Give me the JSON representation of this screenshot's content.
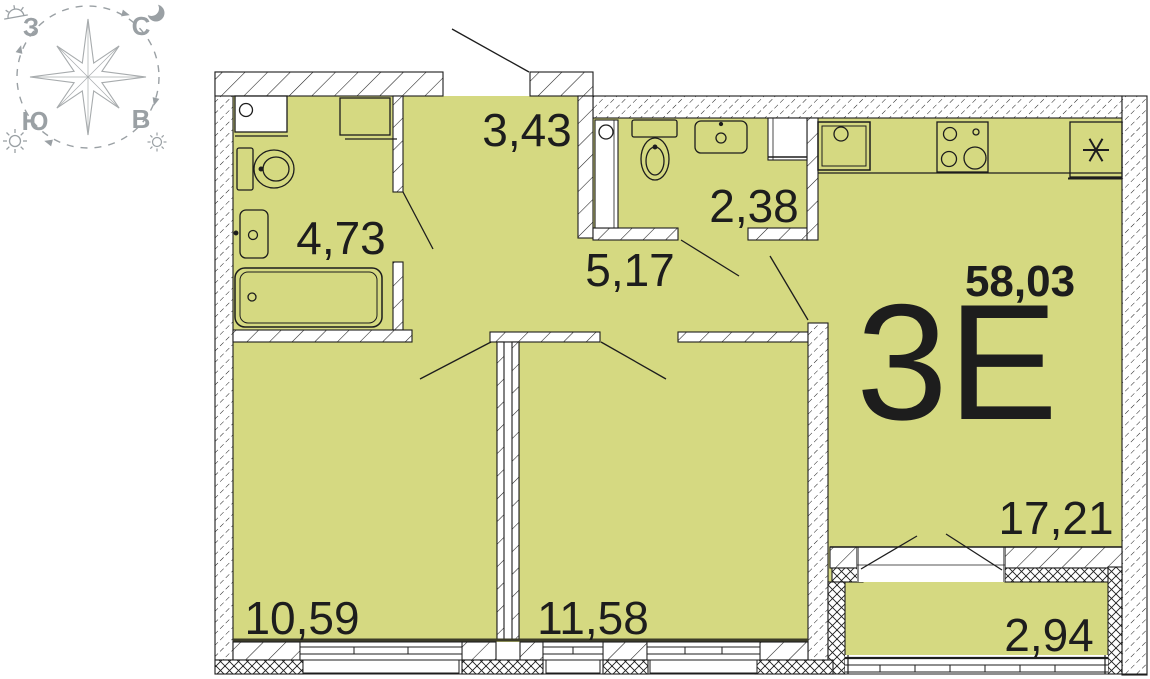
{
  "colors": {
    "floor": "#d5d981",
    "ink": "#1d1d1d",
    "compass": "#9aa0a4",
    "edge": "#3c3c28"
  },
  "compass": {
    "west": "З",
    "north": "С",
    "south": "Ю",
    "east": "В"
  },
  "apartment": {
    "type": "3Е",
    "total_area": "58,03"
  },
  "rooms": {
    "hallway": {
      "area": "3,43"
    },
    "bathroom": {
      "area": "4,73"
    },
    "wc": {
      "area": "2,38"
    },
    "corridor": {
      "area": "5,17"
    },
    "room1": {
      "area": "10,59"
    },
    "room2": {
      "area": "11,58"
    },
    "kitchen_living": {
      "area": "17,21"
    },
    "balcony": {
      "area": "2,94"
    }
  }
}
